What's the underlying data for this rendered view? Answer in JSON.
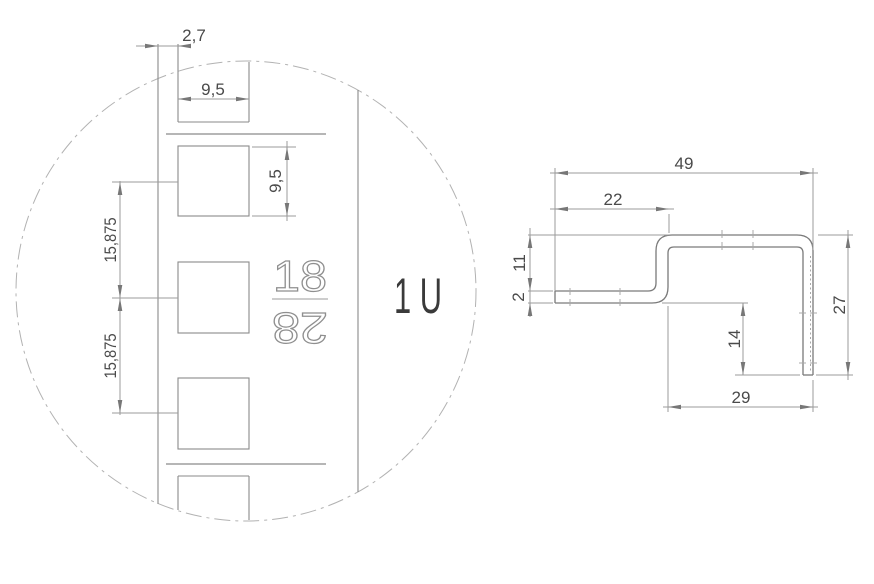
{
  "detail_view": {
    "unit_label": "1 U",
    "stamp_top": "18",
    "stamp_bottom": "28",
    "dim_edge_offset": "2,7",
    "dim_hole_width": "9,5",
    "dim_hole_height": "9,5",
    "dim_pitch_upper": "15,875",
    "dim_pitch_lower": "15,875"
  },
  "profile_view": {
    "dim_overall_width": "49",
    "dim_flange_width": "22",
    "dim_joggle_height": "11",
    "dim_thickness": "2",
    "dim_leg_drop": "14",
    "dim_overall_height": "27",
    "dim_lower_width": "29"
  },
  "colors": {
    "dimension_lines": "#9b9b9b",
    "part_edges": "#8a8a8a",
    "profile_outline": "#7a7a7a",
    "text": "#4a4a4a",
    "background": "#ffffff"
  }
}
